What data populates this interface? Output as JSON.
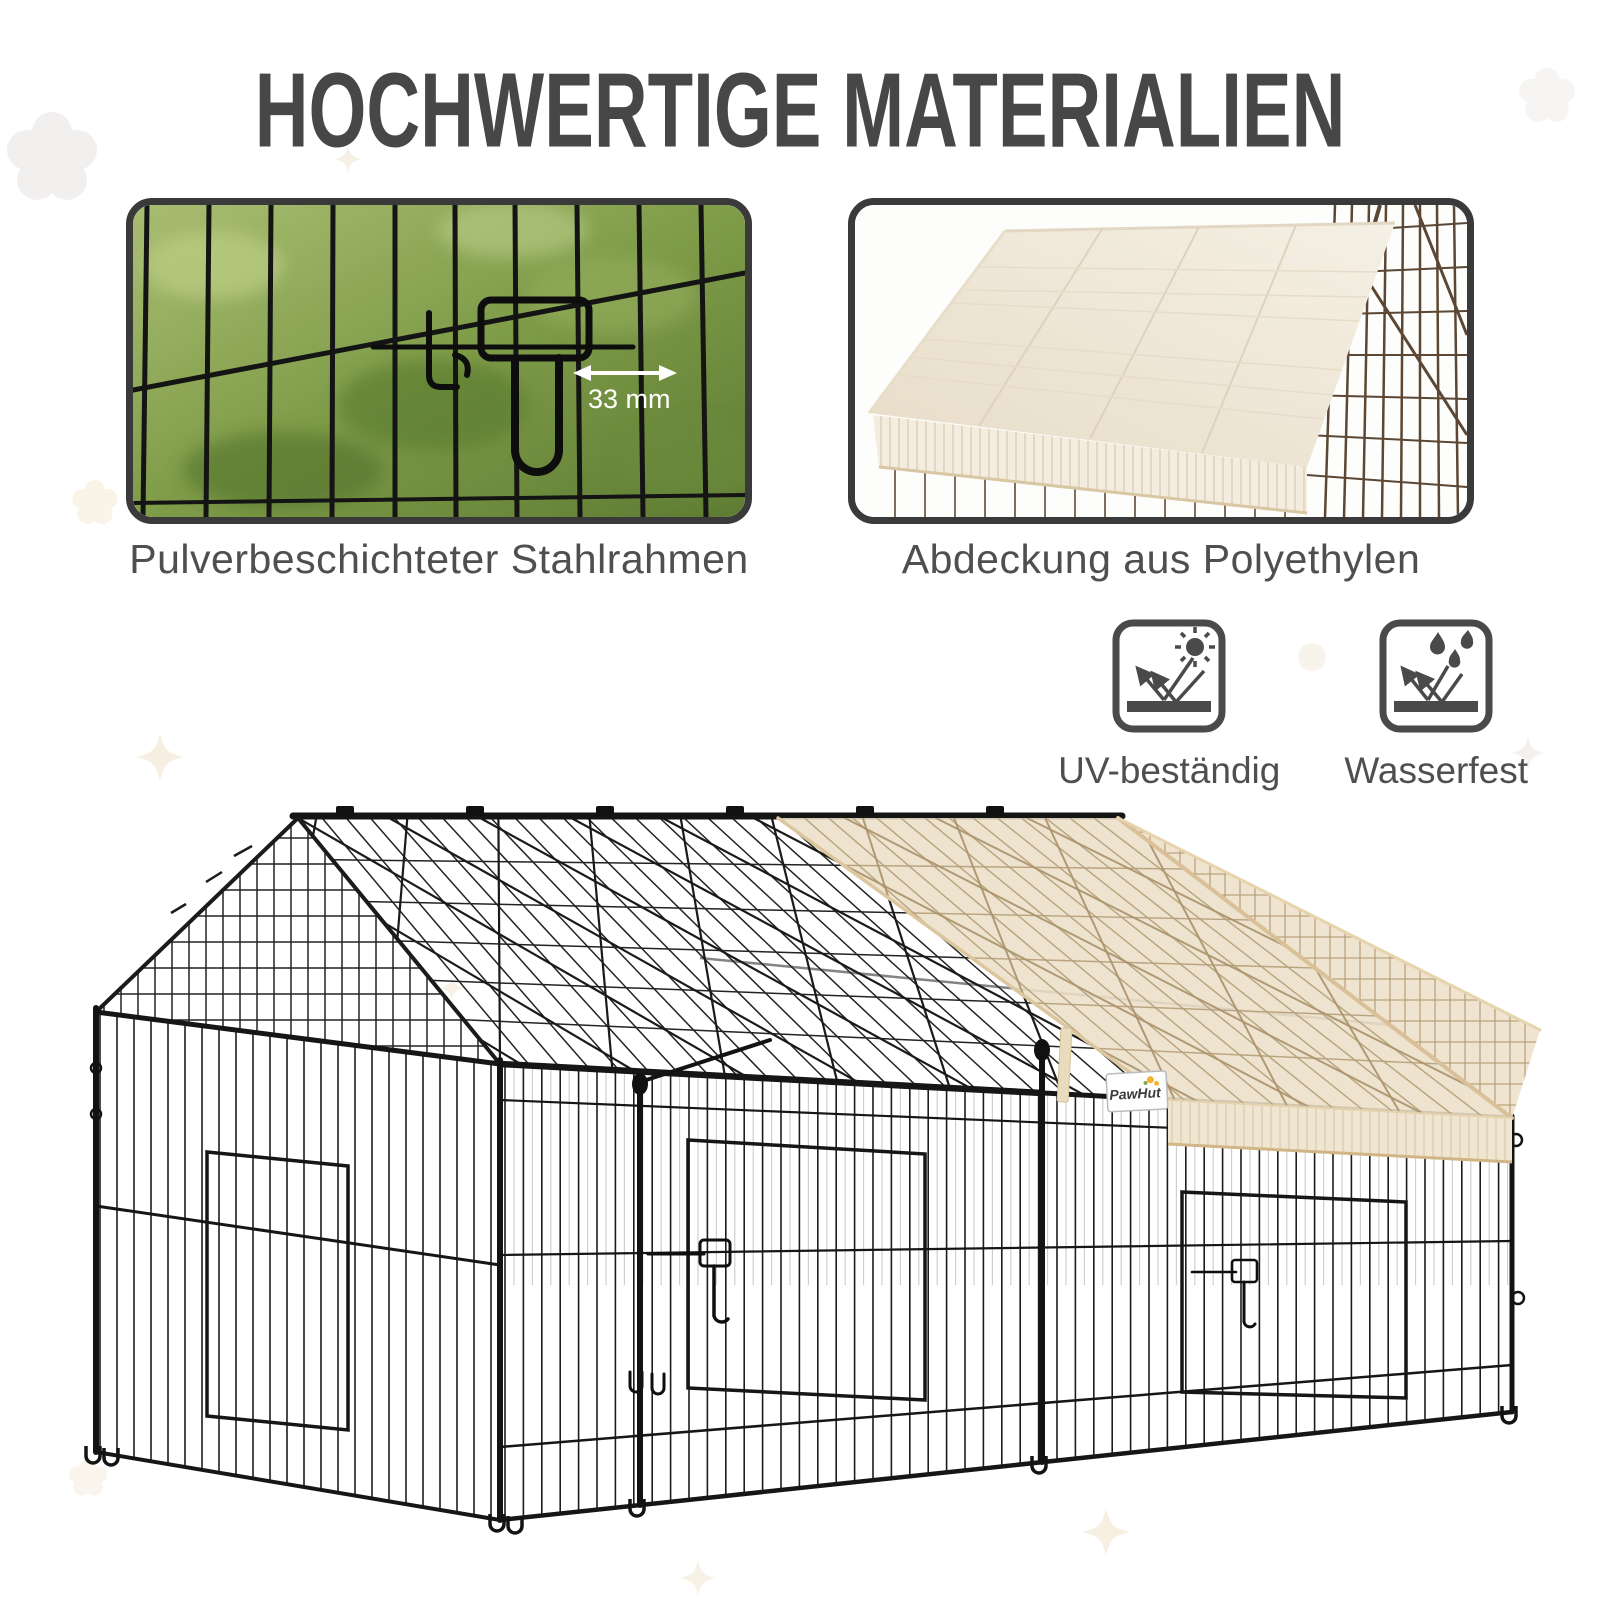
{
  "title": "HOCHWERTIGE MATERIALIEN",
  "features": [
    {
      "id": "steel-frame",
      "caption": "Pulverbeschichteter Stahlrahmen",
      "dimension_label": "33 mm"
    },
    {
      "id": "cover",
      "caption": "Abdeckung aus Polyethylen"
    }
  ],
  "badges": [
    {
      "id": "uv",
      "label": "UV-beständig",
      "icon": "sun-reflection-icon"
    },
    {
      "id": "water",
      "label": "Wasserfest",
      "icon": "water-drops-reflection-icon"
    }
  ],
  "product": {
    "brand": "PawHut"
  },
  "colors": {
    "title": "#474747",
    "caption": "#4f4f4f",
    "icon": "#4a4a4a",
    "wire_black": "#1d1d1d",
    "cover_beige": "#eadfc7",
    "skirt_beige": "#efe5d0",
    "mesh_brown": "#5b4733",
    "grass_green": "#7f9c49"
  }
}
